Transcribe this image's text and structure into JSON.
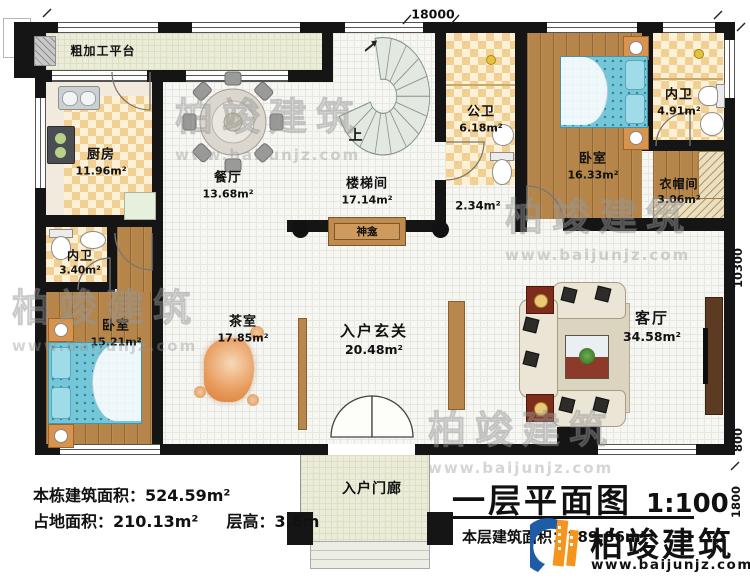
{
  "title_block": {
    "plan_title": "一层平面图",
    "scale": "1:100",
    "floor_area": "本层建筑面积：189.86m²"
  },
  "stats": {
    "total_building_area": "本栋建筑面积：524.59m²",
    "footprint_area": "占地面积：210.13m²",
    "floor_height": "层高：3.6m"
  },
  "dimensions": {
    "top_width": "18000",
    "right_depth": "10300",
    "right_lower": "800",
    "porch_depth": "1800"
  },
  "rooms": {
    "prep_platform": {
      "name": "粗加工平台"
    },
    "kitchen": {
      "name": "厨房",
      "area": "11.96m²"
    },
    "dining": {
      "name": "餐厅",
      "area": "13.68m²"
    },
    "stairwell": {
      "name": "楼梯间",
      "area": "17.14m²"
    },
    "stair_up": "上",
    "public_bath": {
      "name": "公卫",
      "area": "6.18m²"
    },
    "passage_area": "2.34m²",
    "bedroom_ne": {
      "name": "卧室",
      "area": "16.33m²"
    },
    "ensuite_ne": {
      "name": "内卫",
      "area": "4.91m²"
    },
    "cloakroom": {
      "name": "衣帽间",
      "area": "3.06m²"
    },
    "shrine": {
      "name": "神龛"
    },
    "tea_room": {
      "name": "茶室",
      "area": "17.85m²"
    },
    "ensuite_w": {
      "name": "内卫",
      "area": "3.40m²"
    },
    "bedroom_w": {
      "name": "卧室",
      "area": "15.21m²"
    },
    "foyer": {
      "name": "入户玄关",
      "area": "20.48m²"
    },
    "living_room": {
      "name": "客厅",
      "area": "34.58m²"
    },
    "porch": {
      "name": "入户门廊"
    }
  },
  "branding": {
    "logo_text": "柏竣建筑",
    "website": "www.baijunjz.com"
  },
  "watermark": {
    "text": "柏竣建筑",
    "url": "www.baijunjz.com"
  },
  "colors": {
    "wall": "#151515",
    "checker_tile": "#f2cf92",
    "wood_floor": "#b5854a",
    "bed_blue": "#74c7d9",
    "cabinet_wood": "#c08b50",
    "logo_blue": "#1e5ca8",
    "logo_orange": "#f7941d"
  }
}
